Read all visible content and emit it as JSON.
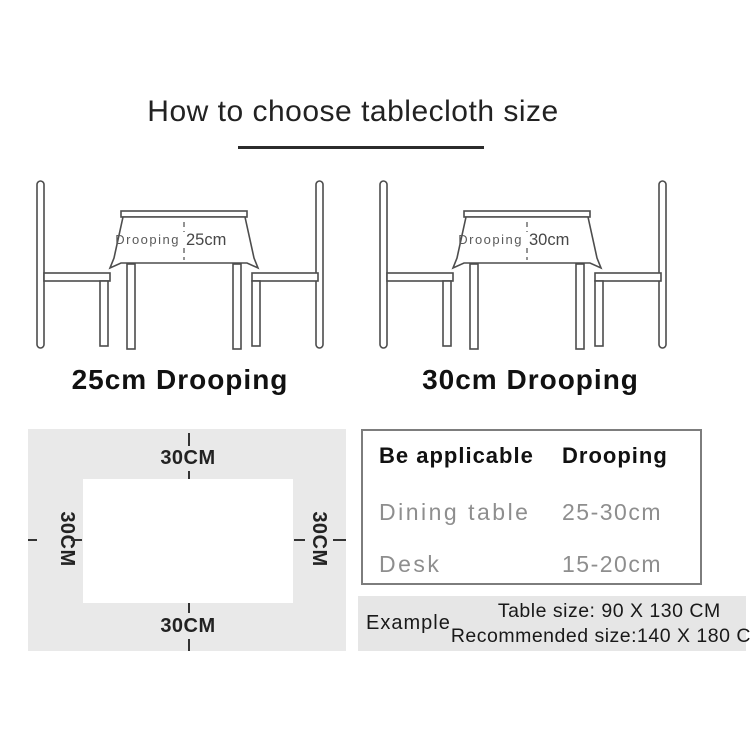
{
  "title": {
    "text": "How to choose tablecloth size"
  },
  "illustrations": [
    {
      "cloth_label": "Drooping",
      "cloth_value": "25cm",
      "caption": "25cm Drooping"
    },
    {
      "cloth_label": "Drooping",
      "cloth_value": "30cm",
      "caption": "30cm Drooping"
    }
  ],
  "measurement_panel": {
    "top_label": "30CM",
    "bottom_label": "30CM",
    "left_label": "30CM",
    "right_label": "30CM"
  },
  "size_table": {
    "col1_header": "Be applicable",
    "col2_header": "Drooping",
    "rows": [
      {
        "name": "Dining table",
        "value": "25-30cm"
      },
      {
        "name": "Desk",
        "value": "15-20cm"
      }
    ]
  },
  "example": {
    "label": "Example",
    "line1": "Table size: 90 X 130 CM",
    "line2": "Recommended size:140 X 180 CM"
  },
  "colors": {
    "line_art": "#4d4d4d",
    "panel_bg": "#e9e9e9",
    "example_bg": "#e6e6e6",
    "table_border": "#7d7d7d",
    "muted_text": "#8e8e8e",
    "dark_text": "#1f1f1f"
  }
}
